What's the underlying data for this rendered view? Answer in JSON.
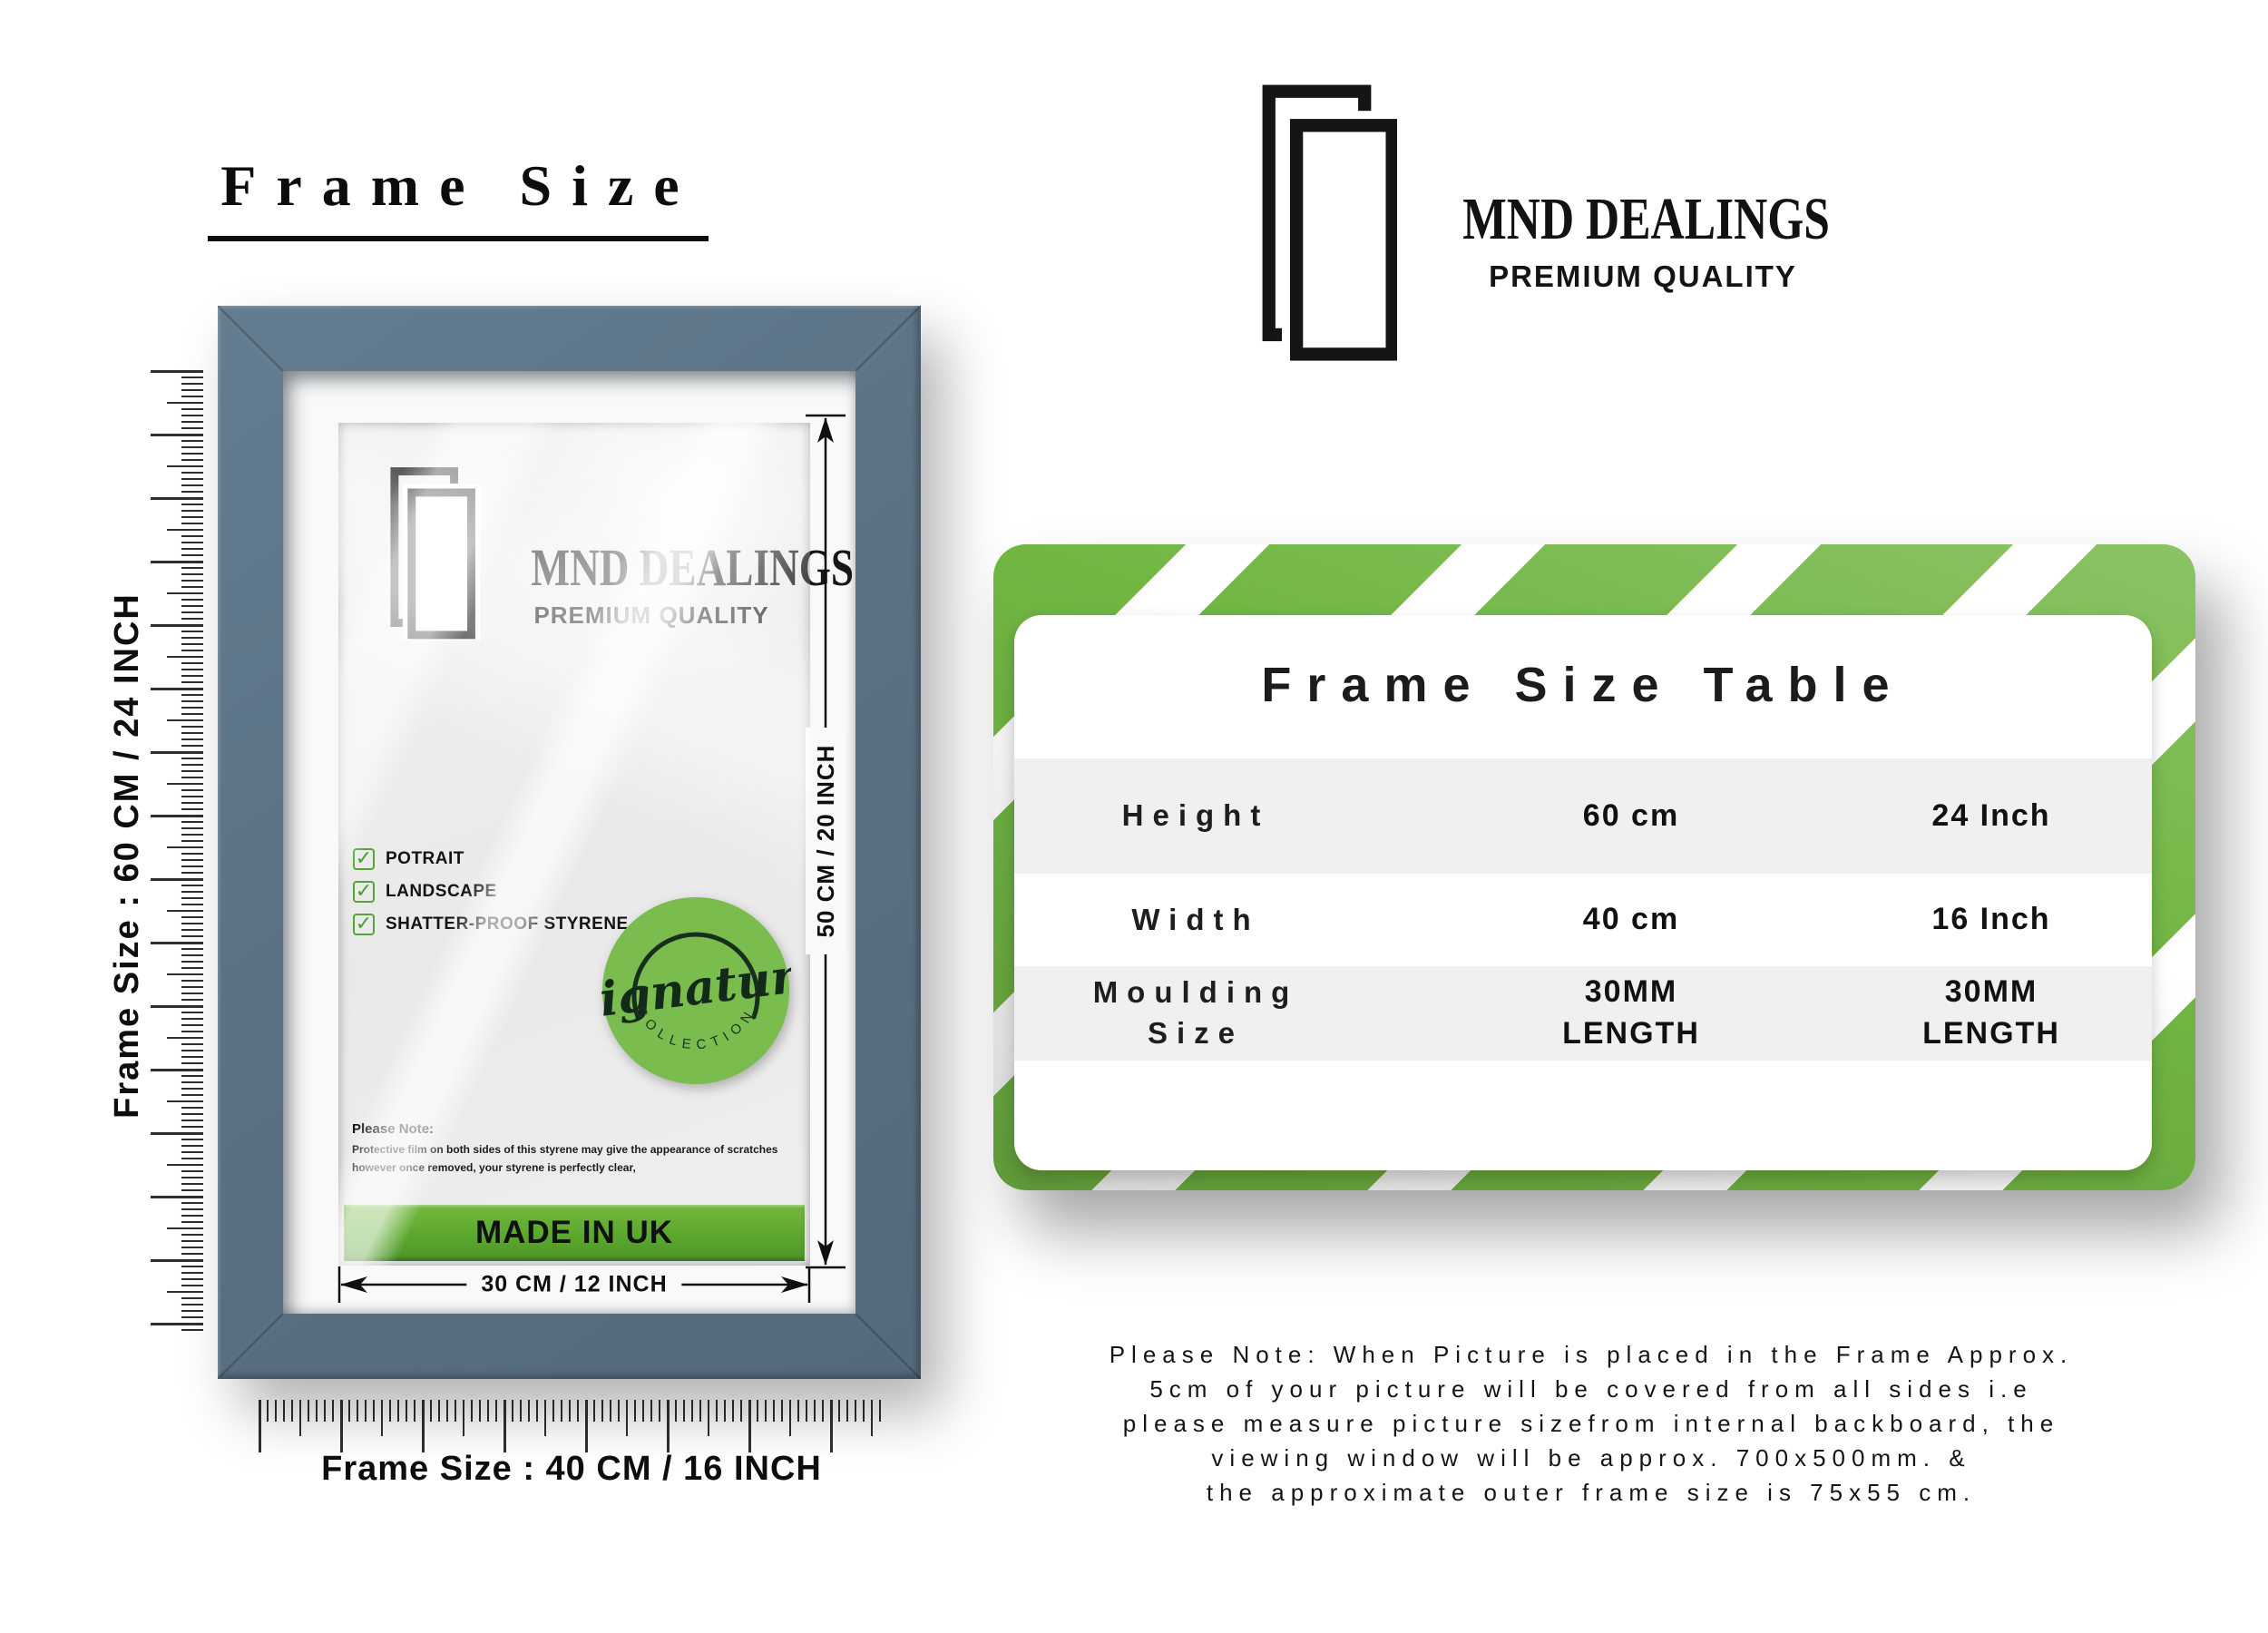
{
  "header": {
    "title": "Frame Size"
  },
  "brand": {
    "name": "MND DEALINGS",
    "tagline": "PREMIUM QUALITY"
  },
  "frame_mockup": {
    "brand_name": "MND DEALINGS",
    "brand_tagline": "PREMIUM QUALITY",
    "features": [
      "POTRAIT",
      "LANDSCAPE",
      "SHATTER-PROOF STYRENE"
    ],
    "badge": {
      "script": "Signature",
      "arc_text": "COLLECTION"
    },
    "note_title": "Please Note:",
    "note_body": "Protective film on both sides of this styrene may give the appearance of scratches however once removed, your styrene is perfectly clear,",
    "made_in": "MADE IN UK",
    "inner_height_label": "50 CM / 20 INCH",
    "inner_width_label": "30 CM / 12 INCH",
    "outer_height_label": "Frame Size : 60 CM / 24 INCH",
    "outer_width_label": "Frame Size : 40 CM / 16 INCH"
  },
  "size_table": {
    "title": "Frame Size Table",
    "rows": [
      {
        "label": "Height",
        "metric": "60 cm",
        "imperial": "24 Inch"
      },
      {
        "label": "Width",
        "metric": "40 cm",
        "imperial": "16 Inch"
      },
      {
        "label": "Moulding Size",
        "metric": "30MM LENGTH",
        "imperial": "30MM LENGTH"
      }
    ]
  },
  "footnote": {
    "lines": [
      "Please Note: When Picture is placed in the Frame Approx.",
      "5cm of your picture will be covered from all sides i.e",
      "please measure picture sizefrom internal backboard, the",
      "viewing window will be approx. 700x500mm. &",
      "the approximate outer frame size is 75x55 cm."
    ]
  },
  "icons": {
    "check": "✓"
  },
  "colors": {
    "frame_slate": "#5b7284",
    "stripe_green": "#71b643",
    "badge_green": "#7abc4d",
    "bar_green_top": "#74b83c",
    "bar_green_bottom": "#4c9526",
    "check_green": "#56a33a"
  }
}
